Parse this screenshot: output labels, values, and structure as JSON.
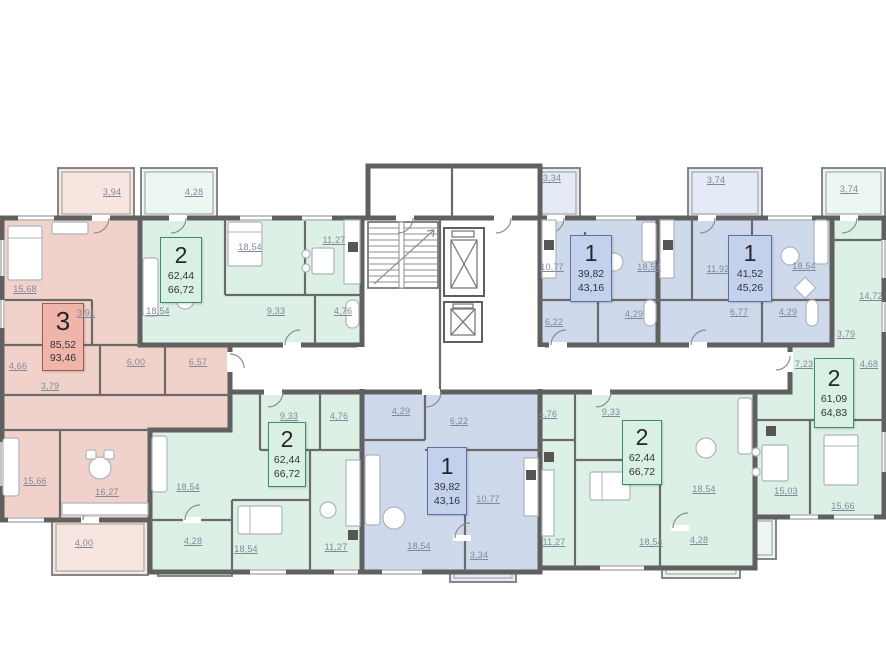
{
  "colors": {
    "apartment_3_rooms_fill": "#f1d2ca",
    "apartment_2_rooms_fill": "#dcf0e6",
    "apartment_1_room_fill": "#cfd9ec",
    "walls": "#606060",
    "label_box_3_bg": "#efb5a9",
    "label_box_3_border": "#9c5a4b",
    "label_box_2_bg": "#d8f1e2",
    "label_box_2_border": "#3f8a6f",
    "label_box_1_bg": "#c4d1ec",
    "label_box_1_border": "#5a72a8",
    "room_label_text": "#82879a"
  },
  "core": {
    "staircase": "staircase",
    "elevators": [
      "elevator-shaft-large",
      "elevator-shaft-small"
    ]
  },
  "apartments": [
    {
      "id": "apt-3-left",
      "palette": "pink",
      "rooms": "3",
      "area_living": "85,52",
      "area_total": "93,46"
    },
    {
      "id": "apt-2-top-left",
      "palette": "green",
      "rooms": "2",
      "area_living": "62,44",
      "area_total": "66,72"
    },
    {
      "id": "apt-1-top-center",
      "palette": "blue",
      "rooms": "1",
      "area_living": "39,82",
      "area_total": "43,16"
    },
    {
      "id": "apt-1-top-right",
      "palette": "blue",
      "rooms": "1",
      "area_living": "41,52",
      "area_total": "45,26"
    },
    {
      "id": "apt-2-right",
      "palette": "green",
      "rooms": "2",
      "area_living": "61,09",
      "area_total": "64,83"
    },
    {
      "id": "apt-2-bottom-left",
      "palette": "green",
      "rooms": "2",
      "area_living": "62,44",
      "area_total": "66,72"
    },
    {
      "id": "apt-1-bottom-center",
      "palette": "blue",
      "rooms": "1",
      "area_living": "39,82",
      "area_total": "43,16"
    },
    {
      "id": "apt-2-bottom-right",
      "palette": "green",
      "rooms": "2",
      "area_living": "62,44",
      "area_total": "66,72"
    }
  ],
  "room_labels": [
    {
      "apt": "apt-3-left",
      "text": "3,94"
    },
    {
      "apt": "apt-3-left",
      "text": "15,68"
    },
    {
      "apt": "apt-3-left",
      "text": "3,91"
    },
    {
      "apt": "apt-3-left",
      "text": "4,66"
    },
    {
      "apt": "apt-3-left",
      "text": "6,00"
    },
    {
      "apt": "apt-3-left",
      "text": "6,57"
    },
    {
      "apt": "apt-3-left",
      "text": "3,79"
    },
    {
      "apt": "apt-3-left",
      "text": "15,66"
    },
    {
      "apt": "apt-3-left",
      "text": "16,27"
    },
    {
      "apt": "apt-3-left",
      "text": "4,00"
    },
    {
      "apt": "apt-2-top-left",
      "text": "4,28"
    },
    {
      "apt": "apt-2-top-left",
      "text": "18,54"
    },
    {
      "apt": "apt-2-top-left",
      "text": "11,27"
    },
    {
      "apt": "apt-2-top-left",
      "text": "18,54"
    },
    {
      "apt": "apt-2-top-left",
      "text": "9,33"
    },
    {
      "apt": "apt-2-top-left",
      "text": "4,76"
    },
    {
      "apt": "apt-1-top-center",
      "text": "3,34"
    },
    {
      "apt": "apt-1-top-center",
      "text": "10,77"
    },
    {
      "apt": "apt-1-top-center",
      "text": "18,54"
    },
    {
      "apt": "apt-1-top-center",
      "text": "6,22"
    },
    {
      "apt": "apt-1-top-center",
      "text": "4,29"
    },
    {
      "apt": "apt-1-top-right",
      "text": "3,74"
    },
    {
      "apt": "apt-1-top-right",
      "text": "11,92"
    },
    {
      "apt": "apt-1-top-right",
      "text": "18,54"
    },
    {
      "apt": "apt-1-top-right",
      "text": "6,77"
    },
    {
      "apt": "apt-1-top-right",
      "text": "4,29"
    },
    {
      "apt": "apt-2-right",
      "text": "3,74"
    },
    {
      "apt": "apt-2-right",
      "text": "14,72"
    },
    {
      "apt": "apt-2-right",
      "text": "3,79"
    },
    {
      "apt": "apt-2-right",
      "text": "7,23"
    },
    {
      "apt": "apt-2-right",
      "text": "4,68"
    },
    {
      "apt": "apt-2-right",
      "text": "15,03"
    },
    {
      "apt": "apt-2-right",
      "text": "15,66"
    },
    {
      "apt": "apt-2-bottom-left",
      "text": "9,33"
    },
    {
      "apt": "apt-2-bottom-left",
      "text": "4,76"
    },
    {
      "apt": "apt-2-bottom-left",
      "text": "18,54"
    },
    {
      "apt": "apt-2-bottom-left",
      "text": "4,28"
    },
    {
      "apt": "apt-2-bottom-left",
      "text": "18,54"
    },
    {
      "apt": "apt-2-bottom-left",
      "text": "11,27"
    },
    {
      "apt": "apt-1-bottom-center",
      "text": "4,29"
    },
    {
      "apt": "apt-1-bottom-center",
      "text": "6,22"
    },
    {
      "apt": "apt-1-bottom-center",
      "text": "10,77"
    },
    {
      "apt": "apt-1-bottom-center",
      "text": "18,54"
    },
    {
      "apt": "apt-1-bottom-center",
      "text": "3,34"
    },
    {
      "apt": "apt-2-bottom-right",
      "text": "4,76"
    },
    {
      "apt": "apt-2-bottom-right",
      "text": "9,33"
    },
    {
      "apt": "apt-2-bottom-right",
      "text": "18,54"
    },
    {
      "apt": "apt-2-bottom-right",
      "text": "11,27"
    },
    {
      "apt": "apt-2-bottom-right",
      "text": "18,54"
    },
    {
      "apt": "apt-2-bottom-right",
      "text": "4,28"
    }
  ]
}
